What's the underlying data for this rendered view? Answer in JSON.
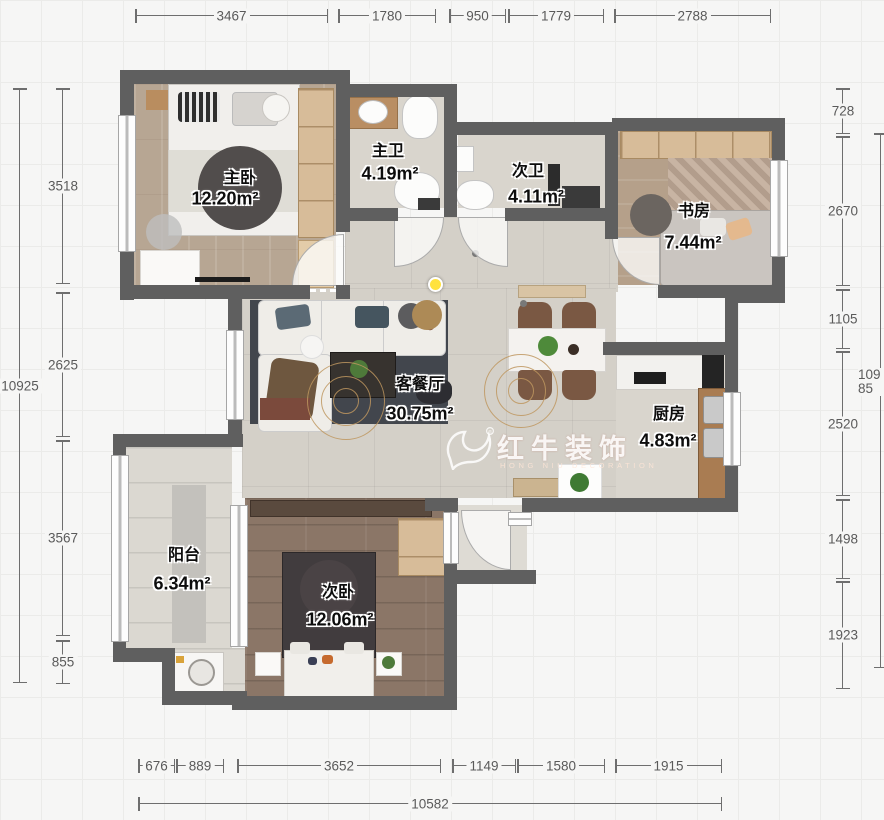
{
  "plan": {
    "rooms": [
      {
        "name": "主卧",
        "area": "12.20m²"
      },
      {
        "name": "主卫",
        "area": "4.19m²"
      },
      {
        "name": "次卫",
        "area": "4.11m²"
      },
      {
        "name": "书房",
        "area": "7.44m²"
      },
      {
        "name": "客餐厅",
        "area": "30.75m²"
      },
      {
        "name": "厨房",
        "area": "4.83m²"
      },
      {
        "name": "阳台",
        "area": "6.34m²"
      },
      {
        "name": "次卧",
        "area": "12.06m²"
      }
    ],
    "watermark": {
      "brand": "红牛装饰",
      "subtitle": "HONG NIU DECORATION",
      "registered": "®"
    }
  },
  "dimensions": {
    "top": [
      "3467",
      "1780",
      "950",
      "1779",
      "2788"
    ],
    "bottom": [
      "676",
      "889",
      "3652",
      "1149",
      "1580",
      "1915"
    ],
    "bottom_total": "10582",
    "left": [
      "3518",
      "2625",
      "3567",
      "855"
    ],
    "left_total": "10925",
    "right": [
      "728",
      "2670",
      "1105",
      "2520",
      "1498",
      "1923"
    ],
    "right_total": "10985"
  },
  "colors": {
    "wall": "#5f5f5f",
    "dimension_line": "#6e6e6e",
    "highlight_dot": "#ffe23e",
    "watermark": "#ffffff"
  }
}
